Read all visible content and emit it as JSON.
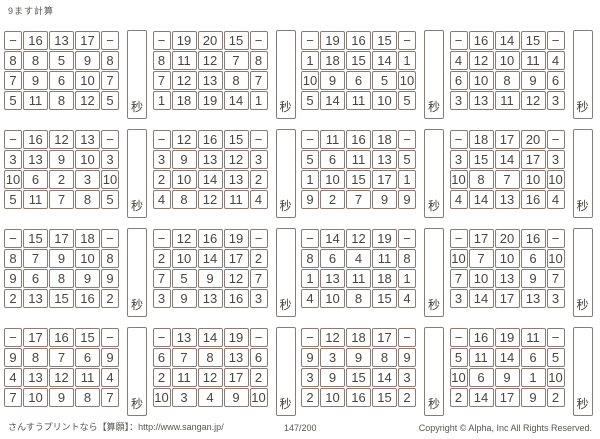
{
  "title": "9ます計算",
  "seconds_label": "秒",
  "colors": {
    "border": "#8a7c72",
    "given_text": "#4a453e",
    "answer_text": "#e23f38",
    "muted_text": "#5a554e"
  },
  "footer": {
    "left": "さんすうプリントなら【算願】：http://www.sangan.jp/",
    "center": "147/200",
    "right": "Copyright © Alpha, Inc All Rights Reserved."
  },
  "grids": [
    {
      "header": [
        "−",
        "16",
        "13",
        "17",
        "−"
      ],
      "rows": [
        [
          "8",
          "8",
          "5",
          "9",
          "8"
        ],
        [
          "7",
          "9",
          "6",
          "10",
          "7"
        ],
        [
          "5",
          "11",
          "8",
          "12",
          "5"
        ]
      ]
    },
    {
      "header": [
        "−",
        "19",
        "20",
        "15",
        "−"
      ],
      "rows": [
        [
          "8",
          "11",
          "12",
          "7",
          "8"
        ],
        [
          "7",
          "12",
          "13",
          "8",
          "7"
        ],
        [
          "1",
          "18",
          "19",
          "14",
          "1"
        ]
      ]
    },
    {
      "header": [
        "−",
        "19",
        "16",
        "15",
        "−"
      ],
      "rows": [
        [
          "1",
          "18",
          "15",
          "14",
          "1"
        ],
        [
          "10",
          "9",
          "6",
          "5",
          "10"
        ],
        [
          "5",
          "14",
          "11",
          "10",
          "5"
        ]
      ]
    },
    {
      "header": [
        "−",
        "16",
        "14",
        "15",
        "−"
      ],
      "rows": [
        [
          "4",
          "12",
          "10",
          "11",
          "4"
        ],
        [
          "6",
          "10",
          "8",
          "9",
          "6"
        ],
        [
          "3",
          "13",
          "11",
          "12",
          "3"
        ]
      ]
    },
    {
      "header": [
        "−",
        "16",
        "12",
        "13",
        "−"
      ],
      "rows": [
        [
          "3",
          "13",
          "9",
          "10",
          "3"
        ],
        [
          "10",
          "6",
          "2",
          "3",
          "10"
        ],
        [
          "5",
          "11",
          "7",
          "8",
          "5"
        ]
      ]
    },
    {
      "header": [
        "−",
        "12",
        "16",
        "15",
        "−"
      ],
      "rows": [
        [
          "3",
          "9",
          "13",
          "12",
          "3"
        ],
        [
          "2",
          "10",
          "14",
          "13",
          "2"
        ],
        [
          "4",
          "8",
          "12",
          "11",
          "4"
        ]
      ]
    },
    {
      "header": [
        "−",
        "11",
        "16",
        "18",
        "−"
      ],
      "rows": [
        [
          "5",
          "6",
          "11",
          "13",
          "5"
        ],
        [
          "1",
          "10",
          "15",
          "17",
          "1"
        ],
        [
          "9",
          "2",
          "7",
          "9",
          "9"
        ]
      ]
    },
    {
      "header": [
        "−",
        "18",
        "17",
        "20",
        "−"
      ],
      "rows": [
        [
          "3",
          "15",
          "14",
          "17",
          "3"
        ],
        [
          "10",
          "8",
          "7",
          "10",
          "10"
        ],
        [
          "4",
          "14",
          "13",
          "16",
          "4"
        ]
      ]
    },
    {
      "header": [
        "−",
        "15",
        "17",
        "18",
        "−"
      ],
      "rows": [
        [
          "8",
          "7",
          "9",
          "10",
          "8"
        ],
        [
          "9",
          "6",
          "8",
          "9",
          "9"
        ],
        [
          "2",
          "13",
          "15",
          "16",
          "2"
        ]
      ]
    },
    {
      "header": [
        "−",
        "12",
        "16",
        "19",
        "−"
      ],
      "rows": [
        [
          "2",
          "10",
          "14",
          "17",
          "2"
        ],
        [
          "7",
          "5",
          "9",
          "12",
          "7"
        ],
        [
          "3",
          "9",
          "13",
          "16",
          "3"
        ]
      ]
    },
    {
      "header": [
        "−",
        "14",
        "12",
        "19",
        "−"
      ],
      "rows": [
        [
          "8",
          "6",
          "4",
          "11",
          "8"
        ],
        [
          "1",
          "13",
          "11",
          "18",
          "1"
        ],
        [
          "4",
          "10",
          "8",
          "15",
          "4"
        ]
      ]
    },
    {
      "header": [
        "−",
        "17",
        "20",
        "16",
        "−"
      ],
      "rows": [
        [
          "10",
          "7",
          "10",
          "6",
          "10"
        ],
        [
          "7",
          "10",
          "13",
          "9",
          "7"
        ],
        [
          "3",
          "14",
          "17",
          "13",
          "3"
        ]
      ]
    },
    {
      "header": [
        "−",
        "17",
        "16",
        "15",
        "−"
      ],
      "rows": [
        [
          "9",
          "8",
          "7",
          "6",
          "9"
        ],
        [
          "4",
          "13",
          "12",
          "11",
          "4"
        ],
        [
          "7",
          "10",
          "9",
          "8",
          "7"
        ]
      ]
    },
    {
      "header": [
        "−",
        "13",
        "14",
        "19",
        "−"
      ],
      "rows": [
        [
          "6",
          "7",
          "8",
          "13",
          "6"
        ],
        [
          "2",
          "11",
          "12",
          "17",
          "2"
        ],
        [
          "10",
          "3",
          "4",
          "9",
          "10"
        ]
      ]
    },
    {
      "header": [
        "−",
        "12",
        "18",
        "17",
        "−"
      ],
      "rows": [
        [
          "9",
          "3",
          "9",
          "8",
          "9"
        ],
        [
          "3",
          "9",
          "15",
          "14",
          "3"
        ],
        [
          "2",
          "10",
          "16",
          "15",
          "2"
        ]
      ]
    },
    {
      "header": [
        "−",
        "16",
        "19",
        "11",
        "−"
      ],
      "rows": [
        [
          "5",
          "11",
          "14",
          "6",
          "5"
        ],
        [
          "10",
          "6",
          "9",
          "1",
          "10"
        ],
        [
          "2",
          "14",
          "17",
          "9",
          "2"
        ]
      ]
    }
  ]
}
